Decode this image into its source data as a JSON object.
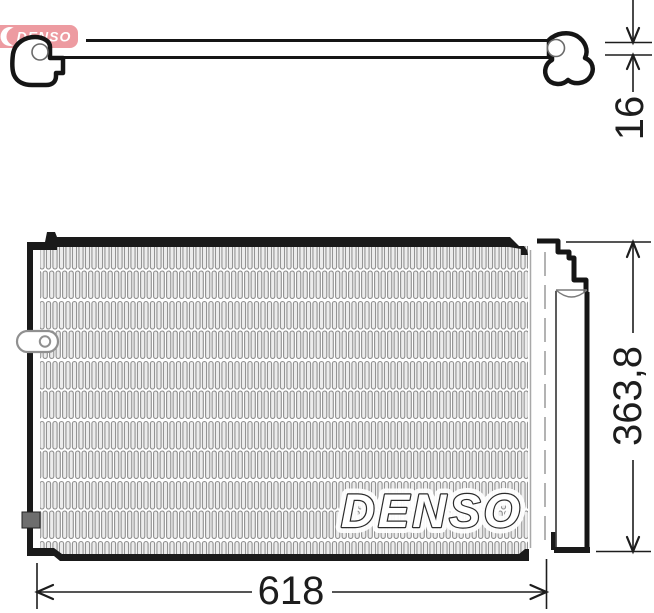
{
  "logo": {
    "text": "DENSO"
  },
  "watermark": {
    "text": "DENSO"
  },
  "dimensions": {
    "thickness": "16",
    "height": "363,8",
    "width": "618"
  },
  "colors": {
    "logo_red": "#dd3a45",
    "line": "#1a1a1a",
    "fin_gray": "#8f8f8f"
  }
}
